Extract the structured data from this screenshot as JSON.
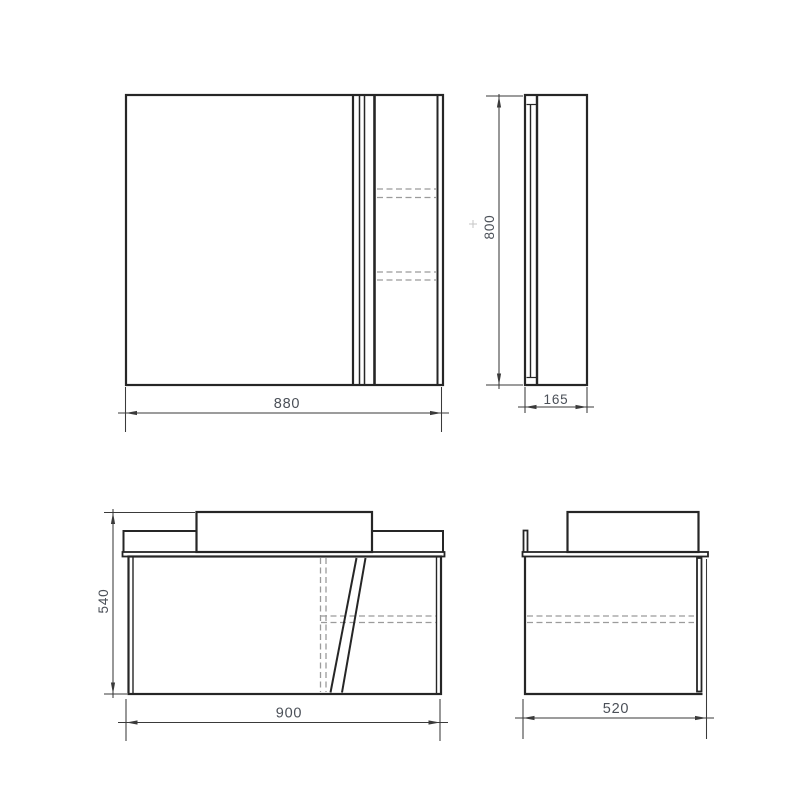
{
  "drawing": {
    "views": {
      "mirror_front": {
        "width_label": "880"
      },
      "mirror_side": {
        "height_label": "800",
        "depth_label": "165"
      },
      "vanity_front": {
        "width_label": "900",
        "height_label": "540"
      },
      "vanity_side": {
        "depth_label": "520"
      }
    },
    "colors": {
      "outline": "#262626",
      "hidden_line": "#9b9b9b",
      "dimension_line": "#3a3a3a",
      "label_text": "#4b5058",
      "background": "#ffffff"
    }
  }
}
